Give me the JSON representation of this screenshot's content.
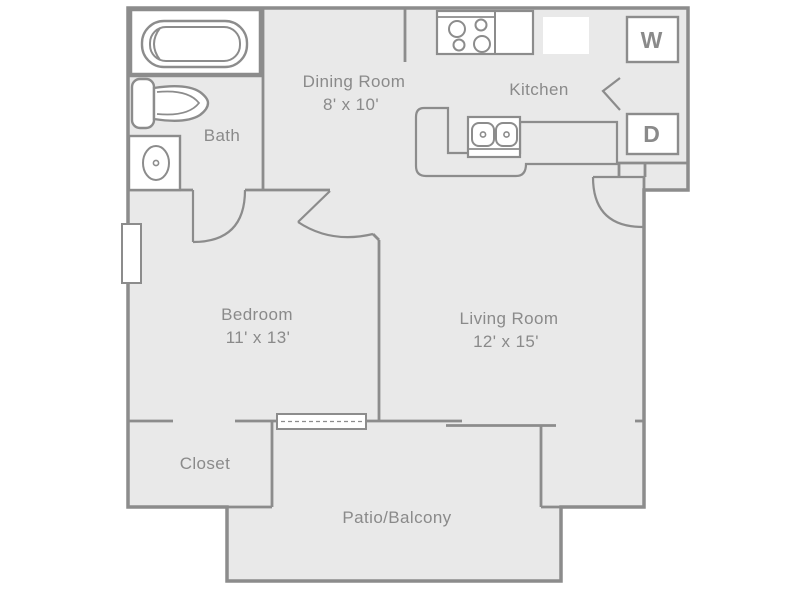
{
  "plan": {
    "title": "One bedroom apartment floor plan",
    "colors": {
      "background": "#ffffff",
      "floor": "#e9e9e9",
      "wall": "#8c8c8c",
      "label": "#8a8a8a",
      "fixture_fill": "#ffffff"
    },
    "rooms": {
      "dining": {
        "name": "Dining Room",
        "dims": "8' x 10'"
      },
      "kitchen": {
        "name": "Kitchen"
      },
      "bath": {
        "name": "Bath"
      },
      "bedroom": {
        "name": "Bedroom",
        "dims": "11' x 13'"
      },
      "living": {
        "name": "Living Room",
        "dims": "12' x 15'"
      },
      "closet": {
        "name": "Closet"
      },
      "patio": {
        "name": "Patio/Balcony"
      }
    },
    "appliances": {
      "washer_letter": "W",
      "dryer_letter": "D"
    },
    "fixture_icons": [
      "bathtub-icon",
      "toilet-icon",
      "bath-sink-icon",
      "stove-icon",
      "refrigerator-icon",
      "kitchen-counter-icon",
      "kitchen-sink-icon",
      "washer-box-icon",
      "dryer-box-icon",
      "window-icon",
      "sliding-door-icon",
      "door-swing-icon"
    ]
  }
}
